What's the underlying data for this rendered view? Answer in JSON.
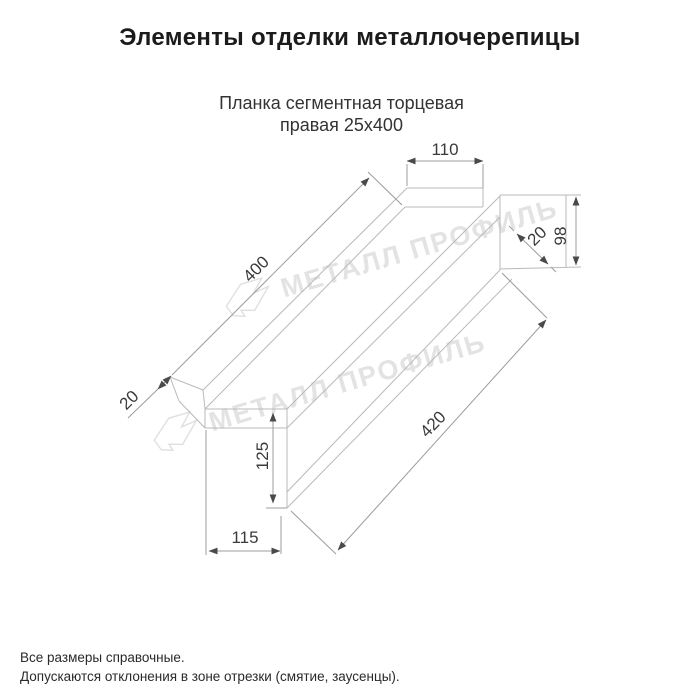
{
  "page": {
    "title": "Элементы отделки металлочерепицы",
    "subtitle_line1": "Планка сегментная торцевая",
    "subtitle_line2": "правая 25х400",
    "footer_line1": "Все размеры справочные.",
    "footer_line2": "Допускаются отклонения в зоне отрезки (смятие, заусенцы)."
  },
  "watermark": {
    "text": "МЕТАЛЛ ПРОФИЛЬ",
    "color": "#e3e3e3"
  },
  "drawing": {
    "dims": {
      "top_width": "110",
      "end_height": "98",
      "end_fold": "20",
      "length_top": "400",
      "length_bottom": "420",
      "left_fold": "20",
      "left_face_height": "125",
      "left_face_width": "115"
    },
    "line_color": "#b9b9b9",
    "dim_color": "#9c9c9c",
    "label_color": "#3a3a3a"
  }
}
